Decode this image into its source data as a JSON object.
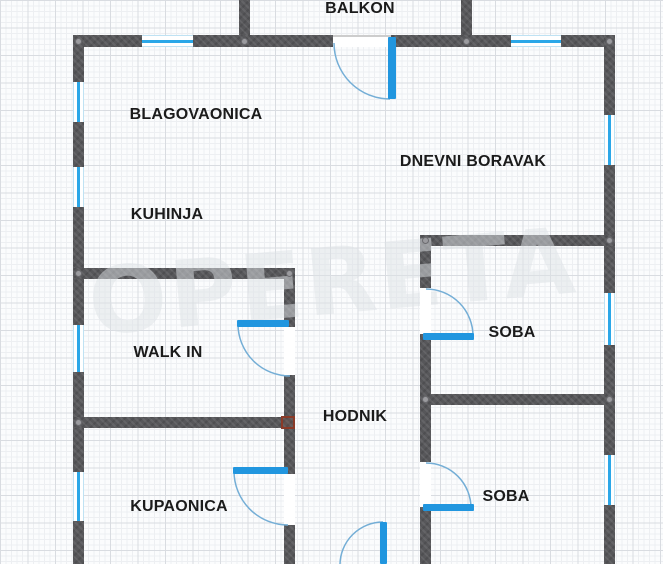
{
  "watermark": {
    "text": "OPERETA"
  },
  "rooms": {
    "balkon": {
      "label": "BALKON"
    },
    "blagovaonica": {
      "label": "BLAGOVAONICA"
    },
    "dnevni_boravak": {
      "label": "DNEVNI BORAVAK"
    },
    "kuhinja": {
      "label": "KUHINJA"
    },
    "walk_in": {
      "label": "WALK IN"
    },
    "hodnik": {
      "label": "HODNIK"
    },
    "soba_1": {
      "label": "SOBA"
    },
    "kupaonica": {
      "label": "KUPAONICA"
    },
    "soba_2": {
      "label": "SOBA"
    }
  },
  "colors": {
    "wall": "#57575a",
    "door_leaf": "#2196df",
    "window_line": "#2aa7e8",
    "swing_arc": "#74aed6",
    "label_text": "#1b1b1b",
    "junction_marker": "#8a3a28"
  }
}
